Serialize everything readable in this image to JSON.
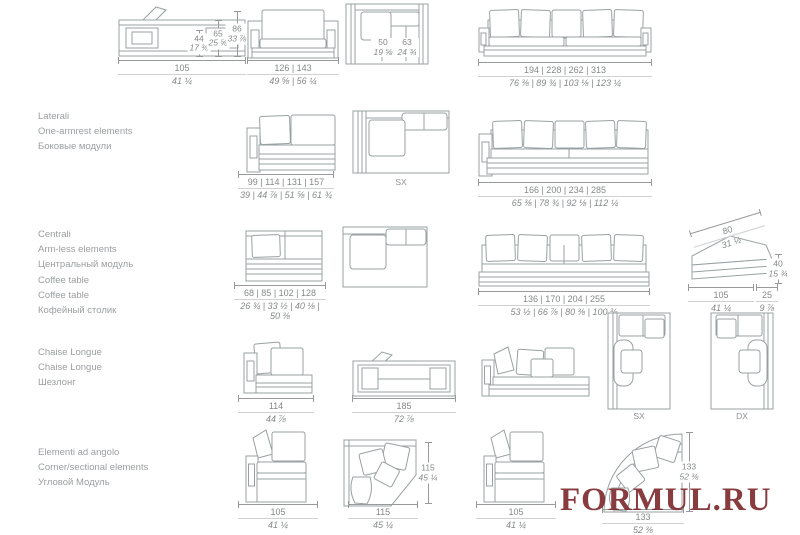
{
  "page": {
    "watermark": "FORMUL.RU"
  },
  "colors": {
    "line": "#9aa0a2",
    "dim_text": "#85888a",
    "label_text": "#9b9ea1",
    "watermark": "#7d282b"
  },
  "sections": {
    "laterali": {
      "line1": "Laterali",
      "line2": "One-armrest elements",
      "line3": "Боковые модули"
    },
    "centrali": {
      "line1": "Centrali",
      "line2": "Arm-less elements",
      "line3": "Центральный модуль"
    },
    "coffee": {
      "line1": "Coffee table",
      "line2": "Coffee table",
      "line3": "Кофейный столик"
    },
    "chaise": {
      "line1": "Chaise Longue",
      "line2": "Chaise Longue",
      "line3": "Шезлонг"
    },
    "angolo": {
      "line1": "Elementi ad angolo",
      "line2": "Corner/sectional elements",
      "line3": "Угловой Модуль"
    }
  },
  "plan_labels": {
    "lateral_sx": "SX",
    "chaise_sx": "SX",
    "chaise_dx": "DX"
  },
  "dims": {
    "armchair_top": {
      "cm": "105",
      "in": "41 ¼"
    },
    "armchair_h1": {
      "cm": "44",
      "in": "17 ⅜"
    },
    "armchair_h2": {
      "cm": "65",
      "in": "25 ⅝"
    },
    "armchair_h3": {
      "cm": "86",
      "in": "33 ⅞"
    },
    "armchair_front": {
      "cm": "126 | 143",
      "in": "49 ⅝ | 56 ¼"
    },
    "plan_d1": {
      "cm": "50",
      "in": "19 ⅝"
    },
    "plan_d2": {
      "cm": "63",
      "in": "24 ¾"
    },
    "sofa4": {
      "cm": "194 | 228 | 262 | 313",
      "in": "76 ⅜ | 89 ¾ | 103 ⅛ | 123 ¼"
    },
    "lateral_small": {
      "cm": "99 | 114 | 131 | 157",
      "in": "39 | 44 ⅞ | 51 ⅝ | 61 ¾"
    },
    "lateral_large": {
      "cm": "166 | 200 | 234 | 285",
      "in": "65 ⅜ | 78 ¾ | 92 ⅛ | 112 ¼"
    },
    "central_small": {
      "cm": "68 | 85 | 102 | 128",
      "in": "26 ¾ | 33 ½ | 40 ⅛ | 50 ⅜"
    },
    "central_large": {
      "cm": "136 | 170 | 204 | 255",
      "in": "53 ½ | 66 ⅞ | 80 ⅜ | 100 ⅜"
    },
    "coffee_diag": {
      "cm": "80",
      "in": "31 ½"
    },
    "coffee_h": {
      "cm": "40",
      "in": "15 ¾"
    },
    "coffee_w": {
      "cm": "105",
      "in": "41 ¼"
    },
    "coffee_d": {
      "cm": "25",
      "in": "9 ⅞"
    },
    "chaise_front": {
      "cm": "114",
      "in": "44 ⅞"
    },
    "chaise_plan": {
      "cm": "185",
      "in": "72 ⅞"
    },
    "corner1": {
      "cm": "105",
      "in": "41 ¼"
    },
    "corner_plan_w": {
      "cm": "115",
      "in": "45 ¼"
    },
    "corner_plan_h": {
      "cm": "115",
      "in": "45 ¼"
    },
    "corner2": {
      "cm": "105",
      "in": "41 ¼"
    },
    "curved_h": {
      "cm": "133",
      "in": "52 ⅜"
    },
    "curved_w": {
      "cm": "133",
      "in": "52 ⅜"
    }
  }
}
